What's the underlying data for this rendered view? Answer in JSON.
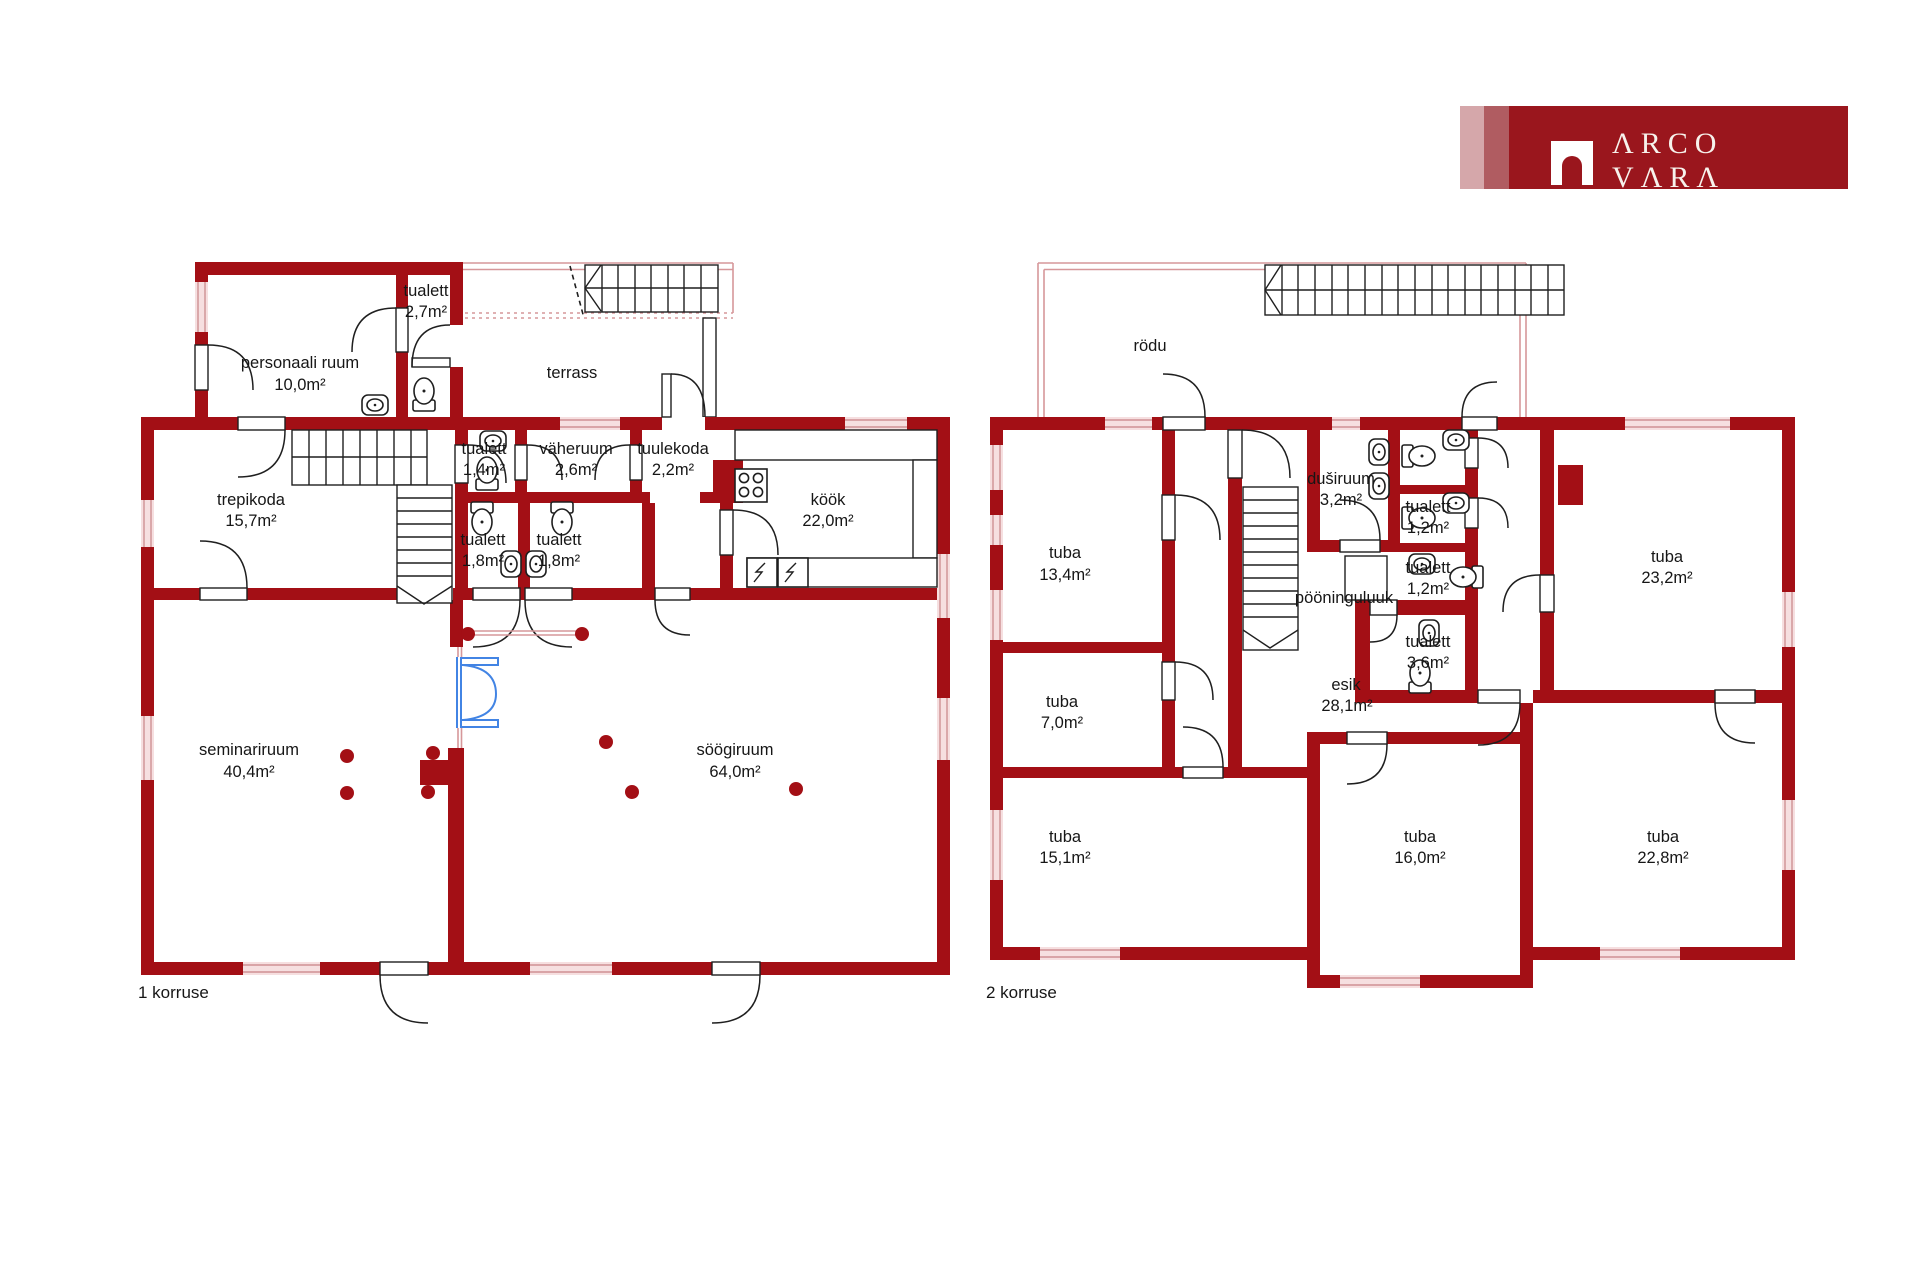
{
  "logo": {
    "brand": "ARCO VARA",
    "display_text": "ΛRCO VΛRΛ",
    "mark": "arch-door-icon"
  },
  "floor1": {
    "caption": "1 korruse",
    "rooms": {
      "personaal": {
        "name": "personaali  ruum",
        "area": "10,0m²"
      },
      "tualett27": {
        "name": "tualett",
        "area": "2,7m²"
      },
      "terrass": {
        "name": "terrass"
      },
      "trepikoda": {
        "name": "trepikoda",
        "area": "15,7m²"
      },
      "tualett14": {
        "name": "tualett",
        "area": "1,4m²"
      },
      "vaheruum": {
        "name": "väheruum",
        "area": "2,6m²"
      },
      "tuulekoda": {
        "name": "tuulekoda",
        "area": "2,2m²"
      },
      "kook": {
        "name": "köök",
        "area": "22,0m²"
      },
      "tualett18a": {
        "name": "tualett",
        "area": "1,8m²"
      },
      "tualett18b": {
        "name": "tualett",
        "area": "1,8m²"
      },
      "seminariruum": {
        "name": "seminariruum",
        "area": "40,4m²"
      },
      "soogiruum": {
        "name": "söögiruum",
        "area": "64,0m²"
      }
    }
  },
  "floor2": {
    "caption": "2 korruse",
    "rooms": {
      "rodu": {
        "name": "rödu"
      },
      "tuba134": {
        "name": "tuba",
        "area": "13,4m²"
      },
      "dusiruum": {
        "name": "duširuum",
        "area": "3,2m²"
      },
      "tualett12a": {
        "name": "tualett",
        "area": "1,2m²"
      },
      "tualett12b": {
        "name": "tualett",
        "area": "1,2m²"
      },
      "pooninguluuk": {
        "name": "pööninguluuk"
      },
      "tualett36": {
        "name": "tualett",
        "area": "3,6m²"
      },
      "esik": {
        "name": "esik",
        "area": "28,1m²"
      },
      "tuba232": {
        "name": "tuba",
        "area": "23,2m²"
      },
      "tuba70": {
        "name": "tuba",
        "area": "7,0m²"
      },
      "tuba151": {
        "name": "tuba",
        "area": "15,1m²"
      },
      "tuba160": {
        "name": "tuba",
        "area": "16,0m²"
      },
      "tuba228": {
        "name": "tuba",
        "area": "22,8m²"
      }
    }
  },
  "colors": {
    "wall": "#a30f15",
    "banner": "#9a161d",
    "stripe_light": "#d5a7aa",
    "stripe_medium": "#b05c61",
    "window": "#f6dfe0",
    "window_line": "#cf9094",
    "outline": "#1f1f1f",
    "door_blue": "#4284e4"
  }
}
